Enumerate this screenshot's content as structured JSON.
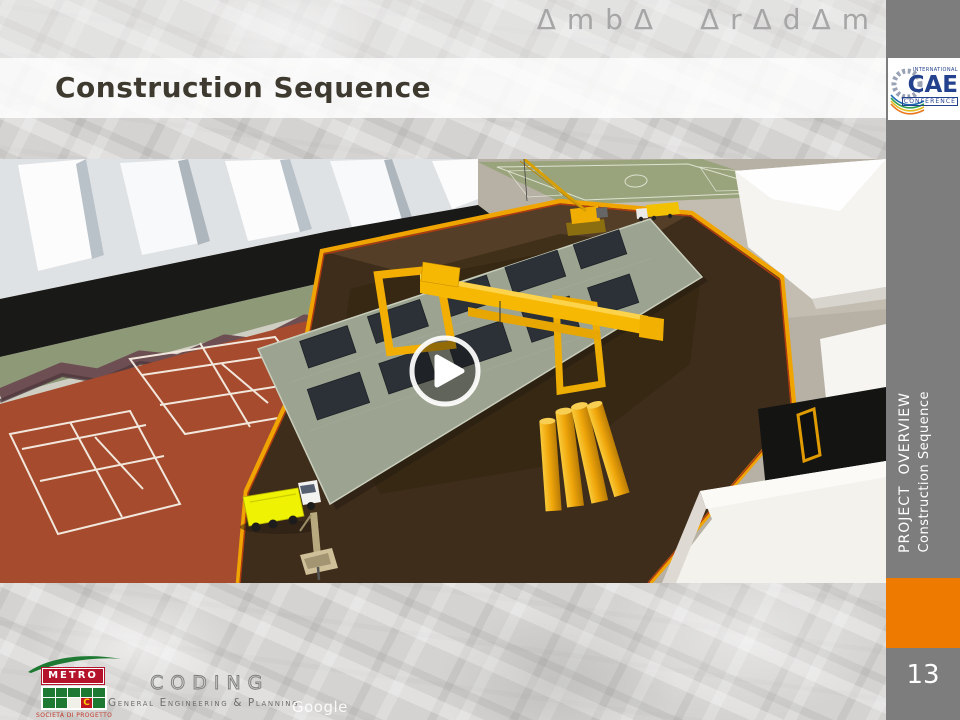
{
  "header": {
    "brand": "ΔmbΔ ΔrΔdΔm",
    "title": "Construction Sequence"
  },
  "cae_logo": {
    "top": "INTERNATIONAL",
    "mid": "CAE",
    "bottom": "CONFERENCE"
  },
  "sidebar": {
    "kicker": "PROJECT  OVERVIEW",
    "subtitle": "Construction Sequence"
  },
  "footer": {
    "page_number": "13",
    "metro_name": "METRO",
    "metro_c": "C",
    "metro_sub": "SOCIETÀ DI PROGETTO",
    "coding_name": "CODING",
    "coding_tagline": "General Engineering & Planning",
    "watermark": "Google"
  },
  "media": {
    "type": "video-thumbnail",
    "play_icon": "play"
  },
  "colors": {
    "accent_orange": "#EF7A00",
    "sidebar_gray": "#7D7D7D",
    "title_text": "#3F3A30",
    "brand_gray": "#A6A6A6",
    "metro_red": "#B5122B",
    "metro_green": "#1E7A33",
    "cae_blue": "#24418E",
    "court_terracotta": "#A64B2D",
    "pit_brown": "#3E2D1B",
    "crane_yellow": "#F6B802"
  }
}
